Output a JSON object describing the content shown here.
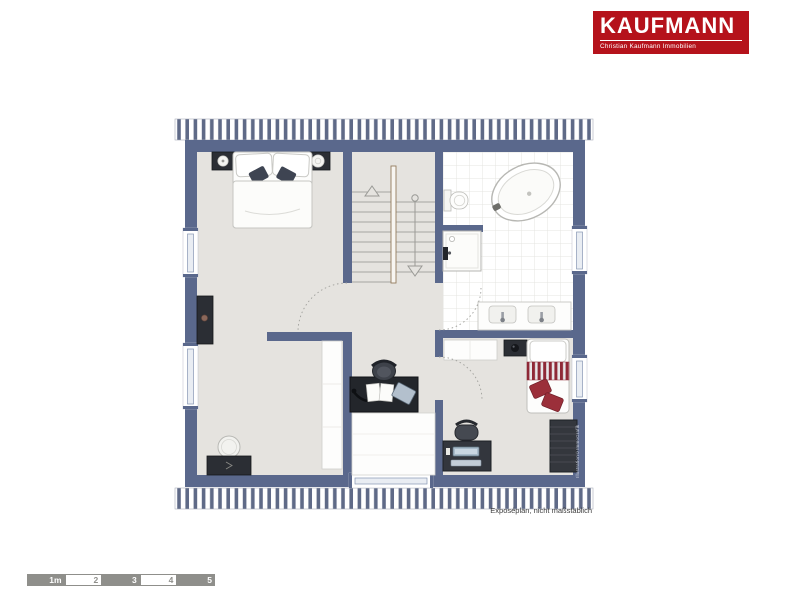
{
  "logo": {
    "brand": "KAUFMANN",
    "tagline": "Christian Kaufmann Immobilien"
  },
  "plan": {
    "caption": "Exposéplan, nicht maßstäblich",
    "credit": "Illustration©ImmoGrafik",
    "elements": [
      "double-bed",
      "nightstand",
      "sideboard",
      "dresser-with-mirror",
      "tall-wardrobe",
      "u-shaped-staircase",
      "freestanding-bathtub",
      "shower",
      "toilet",
      "double-washbasin",
      "single-bed",
      "desk-with-computer",
      "office-chair",
      "work-desk",
      "dark-wardrobe",
      "dormer-window",
      "roof-slope-hatching",
      "door-swing-arcs",
      "windows"
    ]
  },
  "scalebar": {
    "labels": [
      "1m",
      "2",
      "3",
      "4",
      "5"
    ]
  },
  "theme": {
    "brand_red": "#b5121b",
    "wall": "#5a688c",
    "floor": "#e5e3df",
    "hatch": "#5f6a87",
    "tile_line": "#e4e4e0",
    "bed_accent": "#9b2f3a"
  }
}
